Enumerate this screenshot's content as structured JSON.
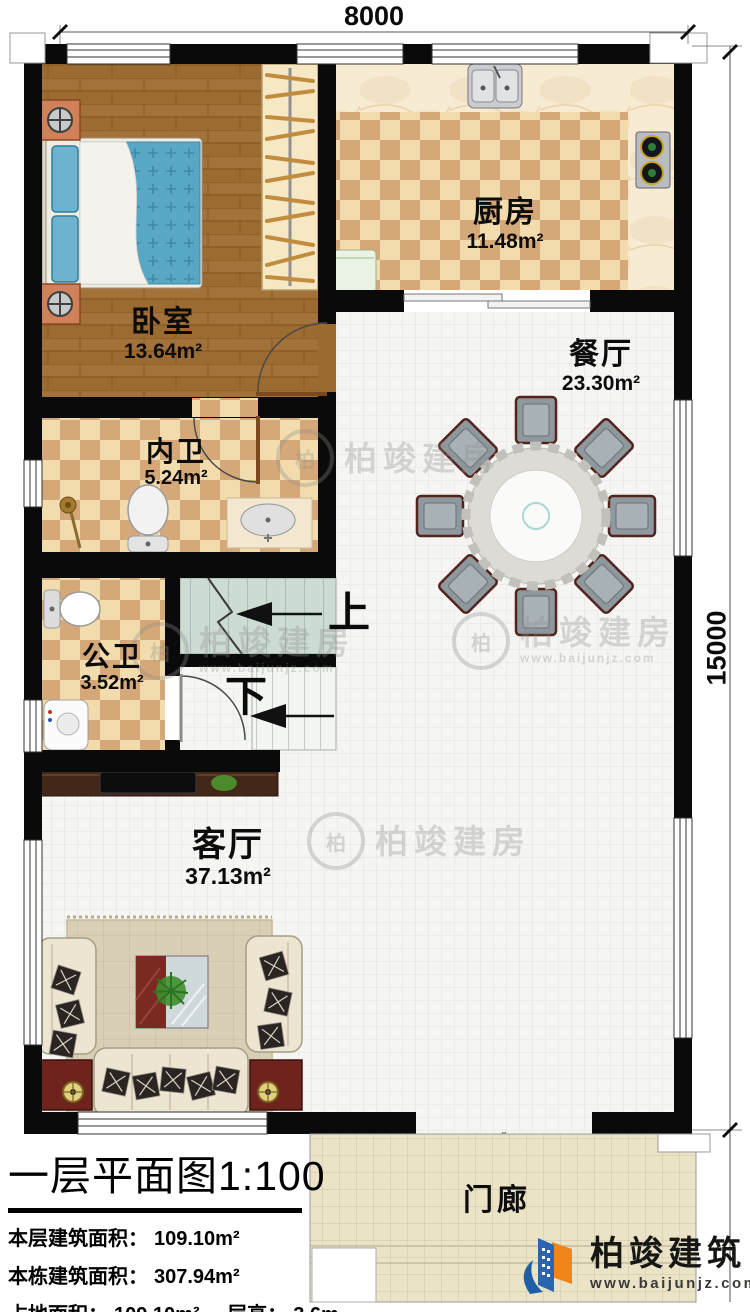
{
  "dims": {
    "width": "8000",
    "height": "15000"
  },
  "rooms": {
    "bedroom": {
      "name": "卧室",
      "area": "13.64m²"
    },
    "kitchen": {
      "name": "厨房",
      "area": "11.48m²"
    },
    "dining": {
      "name": "餐厅",
      "area": "23.30m²"
    },
    "ensuite": {
      "name": "内卫",
      "area": "5.24m²"
    },
    "bath": {
      "name": "公卫",
      "area": "3.52m²"
    },
    "living": {
      "name": "客厅",
      "area": "37.13m²"
    },
    "porch": {
      "name": "门廊",
      "area": ""
    }
  },
  "stairs": {
    "up": "上",
    "down": "下"
  },
  "titleblock": {
    "title": "一层平面图",
    "scale": "1:100",
    "stats": [
      {
        "label": "本层建筑面积：",
        "value": "109.10m²"
      },
      {
        "label": "本栋建筑面积：",
        "value": "307.94m²"
      },
      {
        "label": "占地面积：",
        "value": "109.10m²"
      },
      {
        "label": "层高：",
        "value": "3.6m"
      }
    ]
  },
  "watermark": {
    "text": "柏竣建房",
    "url": "www.baijunjz.com",
    "initial": "柏"
  },
  "brand": {
    "name": "柏竣建筑",
    "url": "www.baijunjz.com"
  },
  "colors": {
    "wall": "#0a0a0a",
    "wood": "#9b6a31",
    "brand_blue": "#1f5fa8",
    "brand_orange": "#f08519"
  }
}
